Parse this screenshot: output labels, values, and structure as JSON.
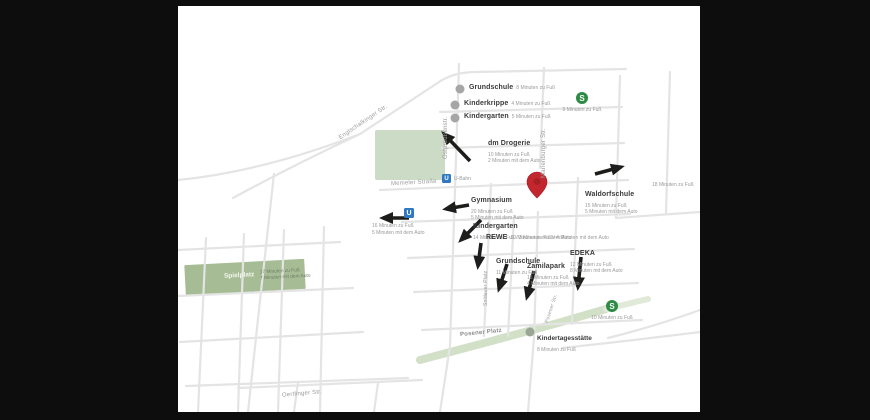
{
  "colors": {
    "background": "#0d0d0d",
    "map_background": "#ffffff",
    "road": "#e4e4e4",
    "park_green": "#ccdbc5",
    "playground_green": "#a5bc94",
    "path_green": "#d2e0c8",
    "arrow": "#1d1d1b",
    "pin_red": "#c4262e",
    "sbahn_green": "#2e8b44",
    "ubahn_blue": "#2f78c2",
    "poi_dot": "#a6a6a6",
    "label_dark": "#3a3a3a",
    "label_gray": "#9a9a9a"
  },
  "transit": {
    "s_glyph": "S",
    "u_glyph": "U",
    "u_stop_label": "U-Bahn"
  },
  "pois": {
    "grundschule_top": {
      "name": "Grundschule",
      "time": "8 Minuten zu Fuß"
    },
    "kinderkrippe": {
      "name": "Kinderkrippe",
      "time": "4 Minuten zu Fuß"
    },
    "kindergarten_top": {
      "name": "Kindergarten",
      "time": "5 Minuten zu Fuß"
    },
    "dm": {
      "name": "dm Drogerie",
      "time_walk": "10 Minuten zu Fuß",
      "time_car": "2 Minuten mit dem Auto"
    },
    "sbahn_top": {
      "time": "9 Minuten zu Fuß"
    },
    "waldorfschule": {
      "name": "Waldorfschule",
      "time_walk": "15 Minuten zu Fuß",
      "time_car": "5 Minuten mit dem Auto"
    },
    "edge_time": {
      "time": "18 Minuten zu Fuß"
    },
    "ubahn_west": {
      "time_walk": "16 Minuten zu Fuß",
      "time_car": "5 Minuten mit dem Auto"
    },
    "gymnasium": {
      "name": "Gymnasium",
      "time_walk": "20 Minuten zu Fuß",
      "time_car": "5 Minuten mit dem Auto"
    },
    "kindergarten_mid": {
      "name": "Kindergarten",
      "time": "14 Minuten zu Fuß / 3 Minuten mit dem Auto"
    },
    "rewe": {
      "name": "REWE",
      "time": "10 Minuten zu Fuß / 4 Minuten mit dem Auto"
    },
    "grundschule_mid": {
      "name": "Grundschule",
      "time": "11 Minuten zu Fuß"
    },
    "zamilapark": {
      "name": "Zamilapark",
      "time_walk": "15 Minuten zu Fuß",
      "time_car": "4 Minuten mit dem Auto"
    },
    "edeka": {
      "name": "EDEKA",
      "time_walk": "12 Minuten zu Fuß",
      "time_car": "8 Minuten mit dem Auto"
    },
    "spielplatz": {
      "name": "Spielplatz",
      "time_walk": "17 Minuten zu Fuß",
      "time_car": "7 Minuten mit dem Auto"
    },
    "kindertagesstaette": {
      "name": "Kindertagesstätte",
      "time": "8 Minuten zu Fuß"
    },
    "sbahn_bottom": {
      "time": "10 Minuten zu Fuß"
    }
  },
  "streets": {
    "englschalkinger": "Englschalkinger Str.",
    "ostpreussen": "Ostpreußenstr.",
    "marienburger": "Marienburger Str.",
    "memeler": "Memeler Straße",
    "soldauer": "Soldauer Platz",
    "posener_str": "Posener Str.",
    "posener_platz": "Posener Platz",
    "oertlinger": "Oertlinger Str."
  }
}
